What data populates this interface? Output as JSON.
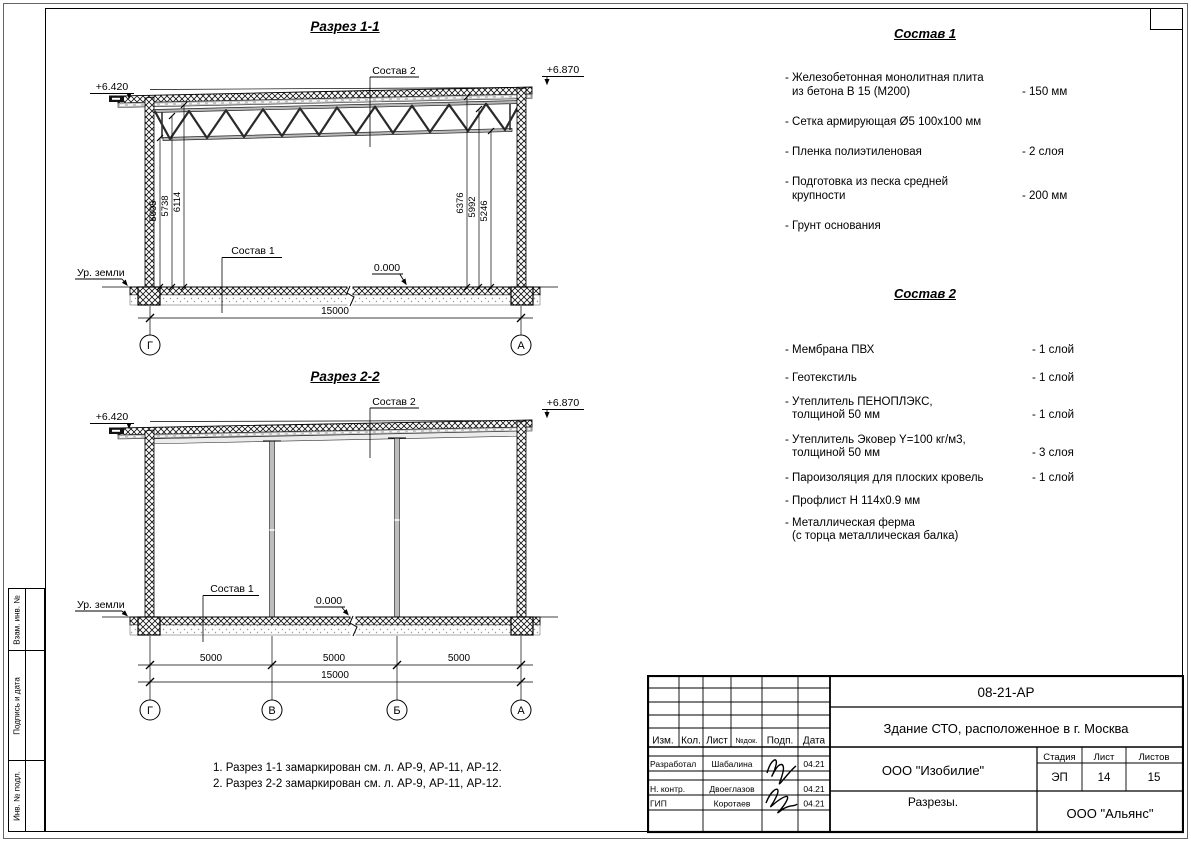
{
  "frame": {
    "stamps": [
      "Взам. инв. №",
      "Подпись и дата",
      "Инв. № подл."
    ]
  },
  "section1": {
    "title": "Разрез 1-1",
    "level_left": "+6.420",
    "level_right": "+6.870",
    "roof_label": "Состав 2",
    "floor_label": "Состав 1",
    "zero_level": "0.000",
    "ground": "Ур. земли",
    "dims_left": [
      "5005",
      "5738",
      "6114"
    ],
    "dims_right": [
      "6376",
      "5992",
      "5246"
    ],
    "total": "15000",
    "axes": [
      "Г",
      "А"
    ]
  },
  "section2": {
    "title": "Разрез 2-2",
    "level_left": "+6.420",
    "level_right": "+6.870",
    "roof_label": "Состав 2",
    "floor_label": "Состав 1",
    "zero_level": "0.000",
    "ground": "Ур. земли",
    "spans": [
      "5000",
      "5000",
      "5000"
    ],
    "total": "15000",
    "axes": [
      "Г",
      "В",
      "Б",
      "А"
    ]
  },
  "sostav1": {
    "title": "Состав 1",
    "items": [
      {
        "l1": "- Железобетонная  монолитная плита",
        "l2": "из бетона В 15 (М200)",
        "value": "- 150 мм"
      },
      {
        "l1": "- Сетка армирующая Ø5 100х100 мм",
        "l2": "",
        "value": ""
      },
      {
        "l1": "- Пленка полиэтиленовая",
        "l2": "",
        "value": "-  2 слоя"
      },
      {
        "l1": "- Подготовка из песка средней",
        "l2": "крупности",
        "value": "- 200 мм"
      },
      {
        "l1": "- Грунт основания",
        "l2": "",
        "value": ""
      }
    ]
  },
  "sostav2": {
    "title": "Состав 2",
    "items": [
      {
        "l1": "- Мембрана ПВХ",
        "l2": "",
        "value": "- 1 слой"
      },
      {
        "l1": "- Геотекстиль",
        "l2": "",
        "value": "- 1 слой"
      },
      {
        "l1": "- Утеплитель ПЕНОПЛЭКС,",
        "l2": "толщиной 50 мм",
        "value": "- 1 слой"
      },
      {
        "l1": "- Утеплитель Эковер Y=100 кг/м3,",
        "l2": "толщиной 50 мм",
        "value": "- 3 слоя"
      },
      {
        "l1": "- Пароизоляция для плоских кровель",
        "l2": "",
        "value": "- 1 слой"
      },
      {
        "l1": "- Профлист Н 114х0.9 мм",
        "l2": "",
        "value": ""
      },
      {
        "l1": "- Металлическая ферма",
        "l2": "(с торца металлическая балка)",
        "value": ""
      }
    ]
  },
  "notes": {
    "line1": "1. Разрез 1-1 замаркирован см. л. АР-9, АР-11, АР-12.",
    "line2": "2. Разрез 2-2 замаркирован см. л. АР-9, АР-11, АР-12."
  },
  "titleblock": {
    "doc_number": "08-21-АР",
    "project_title": "Здание СТО, расположенное в г. Москва",
    "cols": {
      "izm": "Изм.",
      "kol": "Кол.",
      "list": "Лист",
      "ndoc": "№док.",
      "podp": "Подп.",
      "data": "Дата"
    },
    "roles": {
      "r1": "Разработал",
      "r2": "Н. контр.",
      "r3": "ГИП"
    },
    "names": {
      "n1": "Шабалина",
      "n2": "Двоеглазов",
      "n3": "Коротаев"
    },
    "dates": {
      "d1": "04.21",
      "d2": "04.21",
      "d3": "04.21"
    },
    "designer": "ООО \"Изобилие\"",
    "stage_label": "Стадия",
    "sheet_label": "Лист",
    "sheets_label": "Листов",
    "stage": "ЭП",
    "sheet_no": "14",
    "sheets_total": "15",
    "drawing_name": "Разрезы.",
    "company": "ООО \"Альянс\""
  }
}
